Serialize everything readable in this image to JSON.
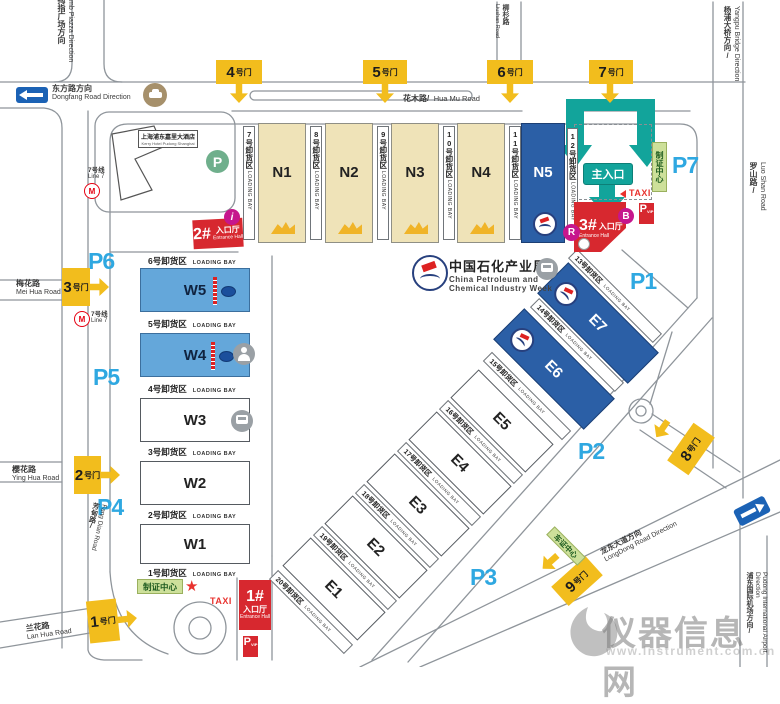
{
  "colors": {
    "gate_yellow": "#F2BD1D",
    "parking_blue": "#2FA8E1",
    "hall_dark_blue": "#2B5FA6",
    "hall_light_blue": "#64A7DA",
    "hall_beige": "#EFE3B8",
    "entrance_red": "#D7282F",
    "arrow_teal": "#12A49B",
    "badge_magenta": "#C6168D",
    "permit_green": "#CDE09A",
    "metro_red": "#E60012",
    "direction_blue": "#1B62B5"
  },
  "event": {
    "title_zh": "中国石化产业周",
    "title_en1": "China Petroleum and",
    "title_en2": "Chemical Industry Week"
  },
  "hotel": {
    "zh": "上海浦东嘉里大酒店",
    "en": "Kerry Hotel Pudong Shanghai"
  },
  "metro": {
    "zh": "7号线",
    "en": "Line 7"
  },
  "directions": {
    "thumb_zh": "大拇指广场方向",
    "thumb_en": "Thumb Piazza Direction",
    "dongfang_zh": "东方路方向",
    "dongfang_en": "Dongfang Road Direction",
    "yangpu_zh": "杨浦大桥方向/",
    "yangpu_en": "Yangpu Bridge Direction",
    "longdong_zh": "龙东大道方向",
    "longdong_en": "LongDong Road Direction",
    "airport_zh": "浦东国际机场方向/",
    "airport_en": "Pudong International Airport Direction"
  },
  "roads": {
    "huamu_zh": "花木路/",
    "huamu_en": "Hua Mu Road",
    "liushan_zh": "柳杉路",
    "liushan_en": "Liushan Road",
    "luoshan_zh": "罗山路/",
    "luoshan_en": "Luo Shan Road",
    "meihua_zh": "梅花路",
    "meihua_en": "Mei Hua Road",
    "yinghua_zh": "樱花路",
    "yinghua_en": "Ying Hua Road",
    "fangdian_zh": "芳甸路/",
    "fangdian_en": "Fang Dian Road",
    "lanhua_zh": "兰花路",
    "lanhua_en": "Lan Hua Road"
  },
  "gates": {
    "g1": {
      "num": "1",
      "suffix": "号门"
    },
    "g2": {
      "num": "2",
      "suffix": "号门"
    },
    "g3": {
      "num": "3",
      "suffix": "号门"
    },
    "g4": {
      "num": "4",
      "suffix": "号门"
    },
    "g5": {
      "num": "5",
      "suffix": "号门"
    },
    "g6": {
      "num": "6",
      "suffix": "号门"
    },
    "g7": {
      "num": "7",
      "suffix": "号门"
    },
    "g8": {
      "num": "8",
      "suffix": "号门"
    },
    "g9": {
      "num": "9",
      "suffix": "号门"
    }
  },
  "parking": {
    "p1": "P1",
    "p2": "P2",
    "p3": "P3",
    "p4": "P4",
    "p5": "P5",
    "p6": "P6",
    "p7": "P7"
  },
  "halls": {
    "n1": "N1",
    "n2": "N2",
    "n3": "N3",
    "n4": "N4",
    "n5": "N5",
    "w1": "W1",
    "w2": "W2",
    "w3": "W3",
    "w4": "W4",
    "w5": "W5",
    "e1": "E1",
    "e2": "E2",
    "e3": "E3",
    "e4": "E4",
    "e5": "E5",
    "e6": "E6",
    "e7": "E7"
  },
  "bays": {
    "en": "LOADING BAY",
    "b1": "1号卸货区",
    "b2": "2号卸货区",
    "b3": "3号卸货区",
    "b4": "4号卸货区",
    "b5": "5号卸货区",
    "b6": "6号卸货区",
    "b7": "7号卸货区",
    "b8": "8号卸货区",
    "b9": "9号卸货区",
    "b10": "10号卸货区",
    "b11": "11号卸货区",
    "b12": "12号卸货区",
    "b13": "13号卸货区",
    "b14": "14号卸货区",
    "b15": "15号卸货区",
    "b16": "16号卸货区",
    "b17": "17号卸货区",
    "b18": "18号卸货区",
    "b19": "19号卸货区",
    "b20": "20号卸货区"
  },
  "entrances": {
    "main": "主入口",
    "h1_num": "1#",
    "h2_num": "2#",
    "h3_num": "3#",
    "hall_zh": "入口厅",
    "hall_en": "Entrance Hall"
  },
  "badges": {
    "taxi": "TAXI",
    "p": "P",
    "vip": "VIP",
    "info": "i",
    "b": "B",
    "r": "R"
  },
  "permits": {
    "zhizheng": "制证中心",
    "chezheng": "车证中心"
  },
  "watermark": {
    "name": "仪器信息网",
    "url": "www.instrument.com.cn"
  }
}
